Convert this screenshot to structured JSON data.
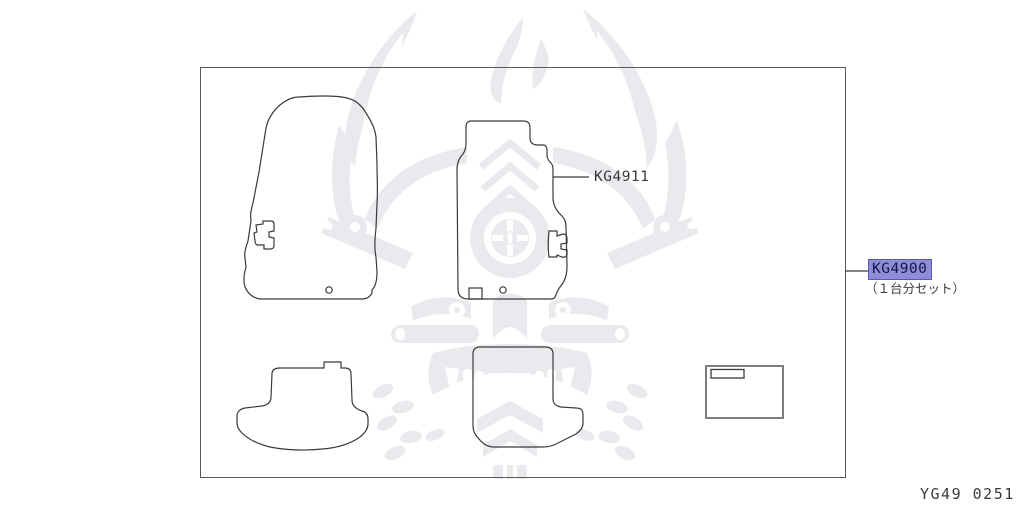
{
  "page": {
    "doc_number": "YG49 0251"
  },
  "diagram": {
    "border_color": "#5a5a5a",
    "line_color": "#3a3a3a",
    "watermark": {
      "icon": "samurai-mask-watermark",
      "color": "#eaeaee"
    },
    "parts": [
      {
        "id": "KG4911",
        "label": "KG4911",
        "highlighted": false
      },
      {
        "id": "KG4900",
        "label": "KG4900",
        "highlighted": true,
        "note": "（１台分セット）",
        "highlight_bg": "#8e8ed6",
        "highlight_border": "#5a5ab4",
        "highlight_text": "#15154a"
      }
    ]
  }
}
